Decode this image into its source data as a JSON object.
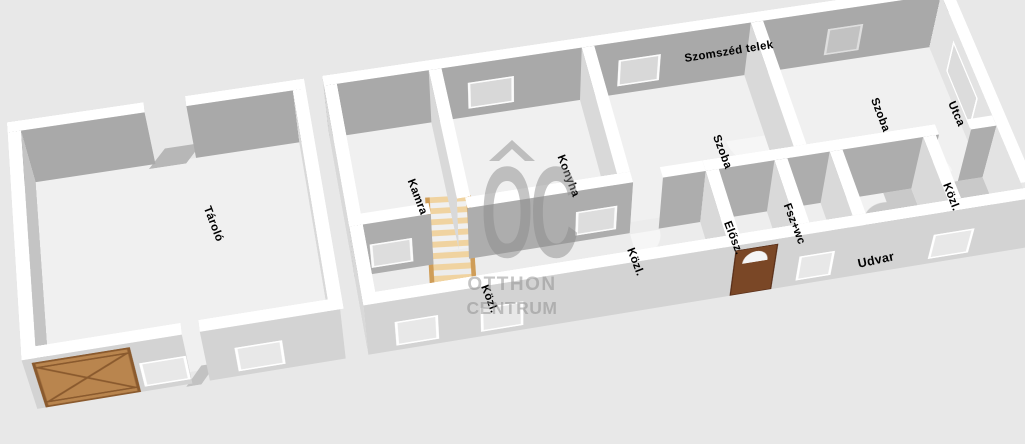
{
  "environment": {
    "neighbor_plot_label": "Szomszéd telek",
    "street_label": "Utca",
    "yard_label": "Udvar"
  },
  "rooms": {
    "storage": {
      "label": "Tároló"
    },
    "pantry": {
      "label": "Kamra"
    },
    "kitchen": {
      "label": "Konyha"
    },
    "room_1": {
      "label": "Szoba"
    },
    "hall_1": {
      "label": "Közl."
    },
    "hall_2": {
      "label": "Közl."
    },
    "entry_hall": {
      "label": "Elősz."
    },
    "bath_wc": {
      "label": "Fsz+wc"
    },
    "room_2": {
      "label": "Szoba"
    },
    "hall_3": {
      "label": "Közl."
    }
  },
  "watermark": {
    "logo_text": "OC",
    "name_line1": "OTTHON",
    "name_line2": "CENTRUM"
  },
  "colors": {
    "background": "#e8e8e8",
    "wall_inner_gray": "#a9a9a9",
    "wall_outer_gray": "#d3d3d3",
    "wall_top_white": "#ffffff",
    "room_floor": "#f0f0f0",
    "yard_floor": "#c9c9c9",
    "garage_gate_wood": "#b9854e",
    "entrance_door_wood": "#7a4726",
    "ladder_wood": "#f0d3a0",
    "label_text": "#000000",
    "watermark_gray": "#8c8c8c"
  }
}
